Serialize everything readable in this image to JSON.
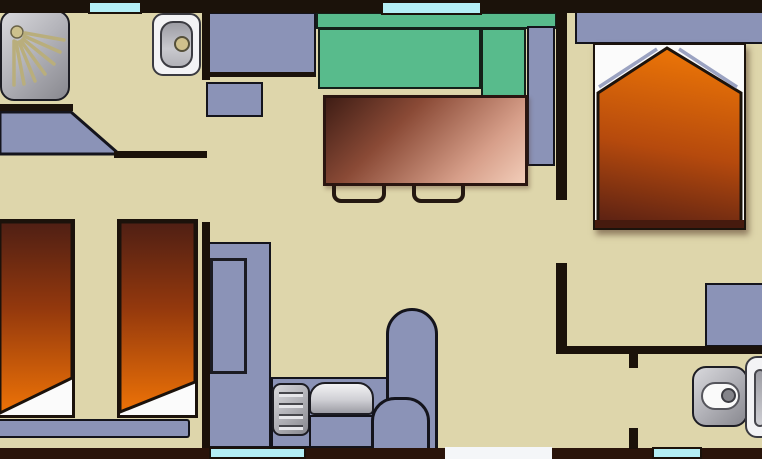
{
  "app": {
    "type": "floor-plan-image",
    "visible_text": "none"
  },
  "floorplan": {
    "rooms": [
      "bathroom",
      "twin-bedroom",
      "living-room",
      "kitchen",
      "master-bedroom",
      "wc",
      "hallway"
    ],
    "furniture": [
      {
        "name": "shower",
        "room": "bathroom"
      },
      {
        "name": "washbasin",
        "room": "bathroom"
      },
      {
        "name": "open-door-leaf",
        "room": "twin-bedroom"
      },
      {
        "name": "twin-bed-1",
        "room": "twin-bedroom"
      },
      {
        "name": "twin-bed-2",
        "room": "twin-bedroom"
      },
      {
        "name": "bed-foot-bench",
        "room": "twin-bedroom"
      },
      {
        "name": "kitchen-counter-top",
        "room": "kitchen"
      },
      {
        "name": "kitchen-appliance",
        "room": "kitchen"
      },
      {
        "name": "kitchen-counter-l",
        "room": "kitchen"
      },
      {
        "name": "stove-hob",
        "room": "kitchen"
      },
      {
        "name": "kitchen-sink",
        "room": "kitchen"
      },
      {
        "name": "round-seat-large",
        "room": "kitchen"
      },
      {
        "name": "round-seat-small",
        "room": "kitchen"
      },
      {
        "name": "corner-sofa",
        "room": "living-room"
      },
      {
        "name": "side-cabinet",
        "room": "living-room"
      },
      {
        "name": "dining-table",
        "room": "living-room"
      },
      {
        "name": "chair-1",
        "room": "living-room"
      },
      {
        "name": "chair-2",
        "room": "living-room"
      },
      {
        "name": "double-bed",
        "room": "master-bedroom"
      },
      {
        "name": "headboard-shelf",
        "room": "master-bedroom"
      },
      {
        "name": "wardrobe",
        "room": "master-bedroom"
      },
      {
        "name": "toilet",
        "room": "wc"
      },
      {
        "name": "wc-basin",
        "room": "wc"
      }
    ],
    "openings": {
      "windows_top": 2,
      "windows_bottom": 2,
      "entrance_door_bottom": 1,
      "interior_door_gaps": 4
    },
    "colors": {
      "floor": "#ded6ab",
      "wall": "#1b120a",
      "wall_bottom": "#2a140a",
      "furniture_blue": "#8b93b7",
      "sofa_green": "#58bb8c",
      "window_cyan": "#b4eef4",
      "door_white": "#f4f6f8",
      "bed_orange_bright": "#ee7307",
      "bed_orange_dark": "#52200f",
      "table_brown_dark": "#3f1d15",
      "table_pink_light": "#f2cdb9",
      "metal_gray": "#a9a9b0",
      "accent_khaki": "#c6ba86"
    }
  }
}
